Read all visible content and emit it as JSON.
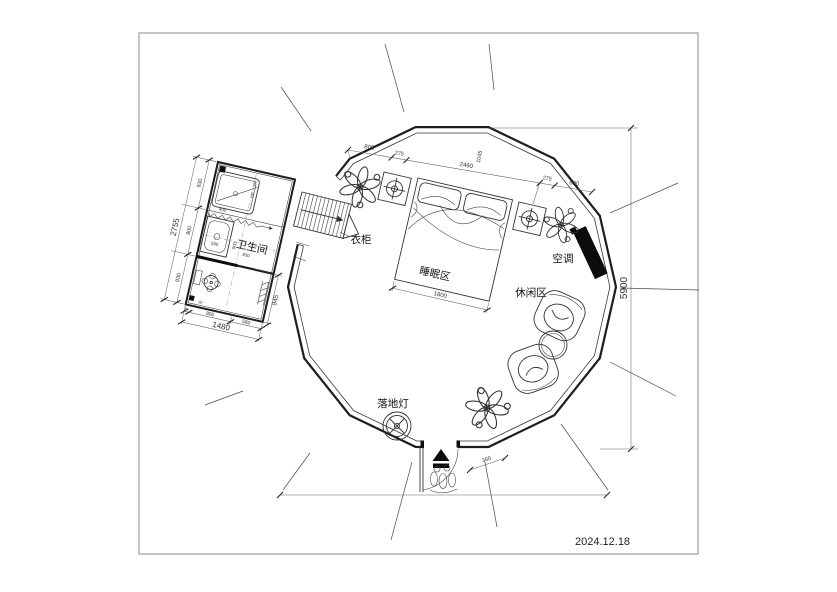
{
  "meta": {
    "date": "2024.12.18"
  },
  "labels": {
    "bathroom": "卫生间",
    "wardrobe": "衣柜",
    "sleeping_area": "睡眠区",
    "leisure_area": "休闲区",
    "air_conditioner": "空调",
    "floor_lamp": "落地灯"
  },
  "dimensions": {
    "top_chain": [
      "805",
      "275",
      "2460",
      "1045",
      "275",
      "690"
    ],
    "height_total": "5900",
    "bed_width": "1800",
    "door_offset": "380",
    "bathroom": {
      "left_chain": [
        "930",
        "900",
        "930"
      ],
      "left_total": "2755",
      "bottom_chain": [
        "800",
        "580"
      ],
      "bottom_corner": "90",
      "bottom_total": "1480",
      "right_side": "945",
      "sink_width": "550",
      "mid_depth": "900",
      "mid_width": "930",
      "tub_width": "400",
      "tub_dim_a": "150",
      "tub_dim_b": "190",
      "corner_dim": "90"
    }
  }
}
